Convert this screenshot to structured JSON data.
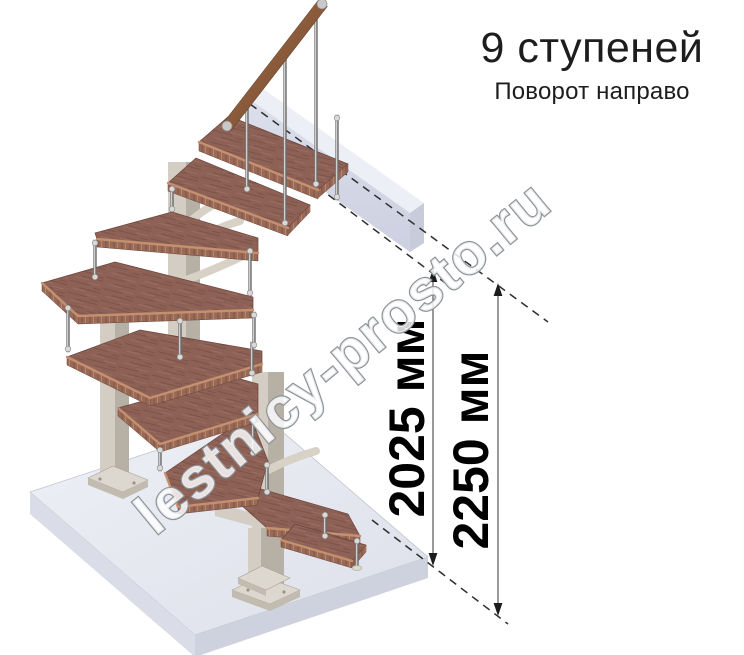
{
  "header": {
    "title": "9 ступеней",
    "subtitle": "Поворот направо"
  },
  "watermark": {
    "text": "lestnicy-prosto.ru"
  },
  "dimensions": [
    {
      "id": "upper-tread-level-height",
      "label": "2025 мм"
    },
    {
      "id": "total-floor-level-height",
      "label": "2250 мм"
    }
  ],
  "staircase": {
    "steps_shown": 9,
    "turn_direction_text": "направо"
  },
  "colors": {
    "tread-top": "#8d6156",
    "tread-grain": "#6f4a40",
    "tread-grain-light": "#a37766",
    "tread-edge": "#9a6a58",
    "tread-edge-dark": "#7b5044",
    "tread-edge-light": "#bd8a67",
    "nosing": "#c49070",
    "outline": "#6b453c",
    "column-light": "#d3cdc3",
    "column-dark": "#b7b0a4",
    "column-top": "#e6e1d8",
    "branch": "#d8d1c6",
    "plate": "#ddd8cf",
    "plate-side": "#c2bcb0",
    "floor-top": "#e9ebf2",
    "floor-left": "#dadce7",
    "floor-right": "#ced1de",
    "beam-top": "#edeff6",
    "beam-front": "#d8dbe8",
    "beam-end": "#c7cbda",
    "rail-cap": "#c9c9c9",
    "dash": "#2f2f2f",
    "dim-line": "#6e6e6e",
    "dim-arrow": "#1c1c1c",
    "text": "#1d1d1d",
    "dim-text": "#000000",
    "wm-fill": "#ffffff",
    "wm-stroke": "#8e939a"
  }
}
